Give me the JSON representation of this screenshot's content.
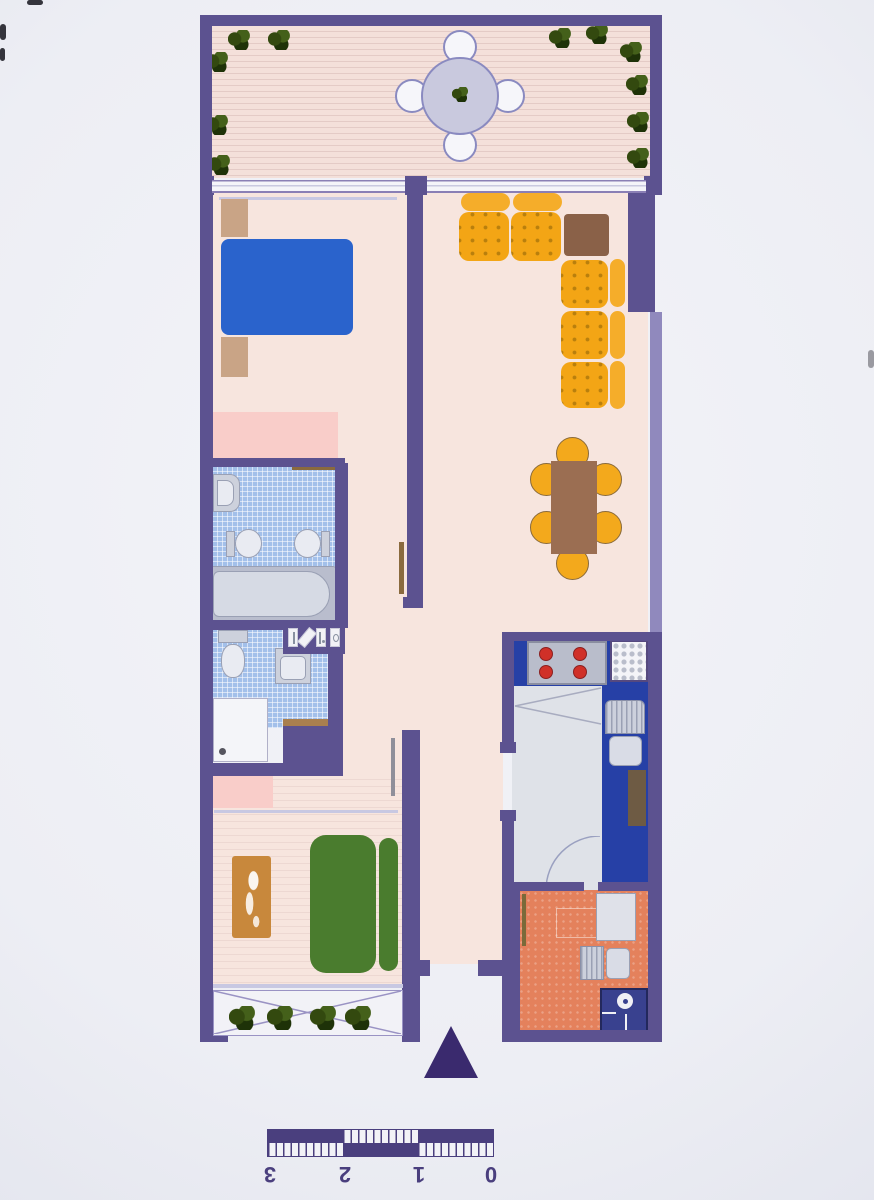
{
  "scale_bar": {
    "labels": [
      "3",
      "2",
      "1",
      "0"
    ],
    "upside_down": true,
    "segments": 3
  },
  "inventory": {
    "terrace_plants": 11,
    "terrace_chairs": 4,
    "sofa_seats": 5,
    "dining_chairs": 6,
    "stove_burners": 4,
    "planter_plants": 4
  },
  "colors": {
    "wall": "#5c5290",
    "wall_light": "#9089bd",
    "floor": "#f7e5de",
    "deck": "#f4e0da",
    "tile": "#a3c0ea",
    "wardrobe": "#f9cdc9",
    "sofa": "#f3a515",
    "sofa_dot": "#b97f0d",
    "sofa_back": "#f5ad2a",
    "chair": "#f3a91c",
    "corner_table": "#8a6148",
    "dining_table": "#9b6e52",
    "bed_blue": "#2a63cc",
    "bed_green": "#4a7c2e",
    "nightstand": "#c9a486",
    "rug": "#c8883c",
    "kitchen_blue": "#2640a6",
    "kitchen_floor": "#dfe2e8",
    "fixture": "#cdd1dc",
    "burner": "#d03028",
    "utility": "#e4815c",
    "plant": "#33490f",
    "scale": "#4a3f7e",
    "arrow": "#3a2a6e",
    "table_top": "#c9c9de"
  }
}
